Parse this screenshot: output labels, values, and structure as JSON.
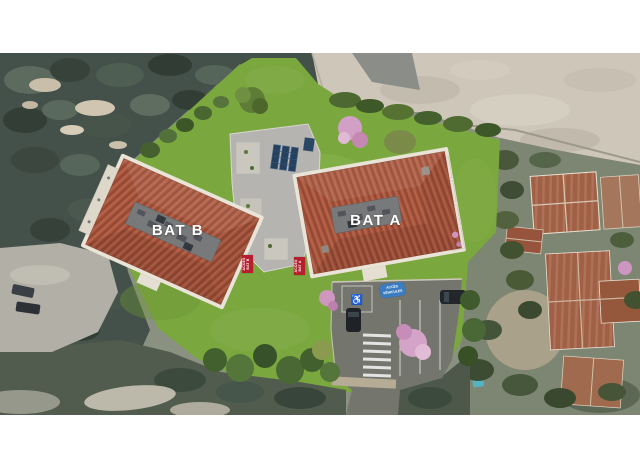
{
  "site_plan": {
    "building_a_label": "BAT A",
    "building_b_label": "BAT B",
    "access_bat_a": {
      "line1": "ACCÈS",
      "line2": "BAT A"
    },
    "access_bat_b": {
      "line1": "ACCÈS",
      "line2": "BAT B"
    },
    "access_vehicules": {
      "line1": "ACCÈS",
      "line2": "VÉHICULES"
    },
    "handicap_icon_glyph": "♿",
    "colors": {
      "access_label_red": "#b71f2e",
      "access_vehicle_blue": "#3c7cc0",
      "label_text_white": "#ffffff",
      "lawn_green": "#7aa73e",
      "roof_terracotta": "#a5523b",
      "flat_roof_gray": "#b5b4b0",
      "concrete_beige": "#cdc6b9",
      "forest_dark": "#44504a",
      "asphalt_gray": "#74766d"
    }
  }
}
